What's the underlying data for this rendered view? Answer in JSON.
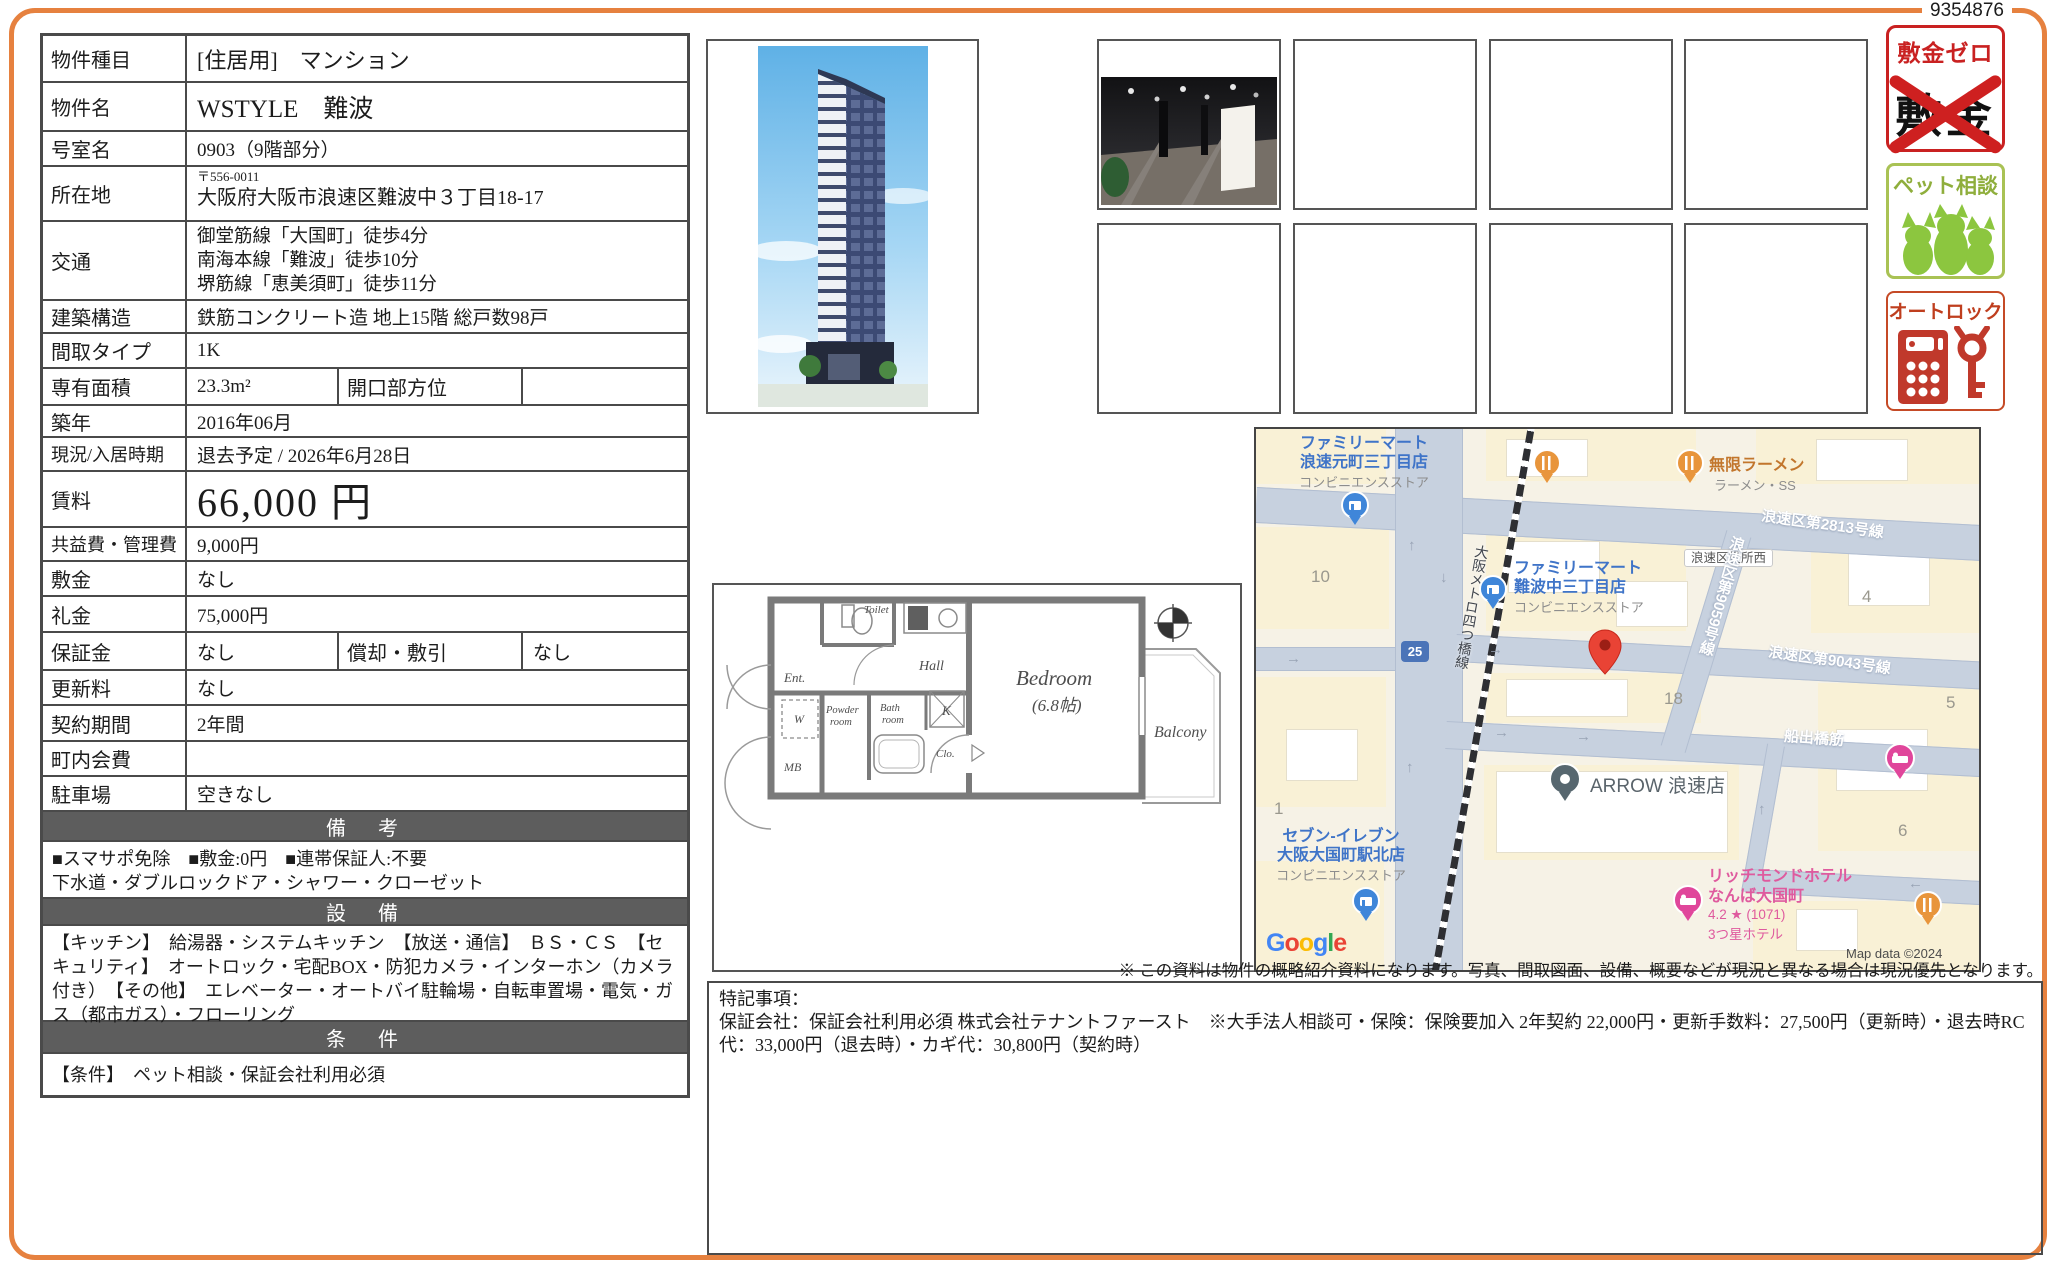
{
  "page": {
    "doc_number": "9354876",
    "disclaimer": "※ この資料は物件の概略紹介資料になります。写真、間取図面、設備、概要などが現況と異なる場合は現況優先となります。"
  },
  "table": {
    "rows": {
      "type": {
        "label": "物件種目",
        "value": "[住居用]　マンション"
      },
      "name": {
        "label": "物件名",
        "value": "WSTYLE　難波"
      },
      "room": {
        "label": "号室名",
        "value": "0903（9階部分）"
      },
      "address": {
        "label": "所在地",
        "zip": "〒556-0011",
        "value": "大阪府大阪市浪速区難波中３丁目18-17"
      },
      "access": {
        "label": "交通",
        "line1": "御堂筋線「大国町」徒歩4分",
        "line2": "南海本線「難波」徒歩10分",
        "line3": "堺筋線「恵美須町」徒歩11分"
      },
      "structure": {
        "label": "建築構造",
        "value": "鉄筋コンクリート造 地上15階 総戸数98戸"
      },
      "layout": {
        "label": "間取タイプ",
        "value": "1K"
      },
      "area": {
        "label": "専有面積",
        "value": "23.3m²",
        "sublabel": "開口部方位",
        "subvalue": ""
      },
      "built": {
        "label": "築年",
        "value": "2016年06月"
      },
      "status": {
        "label": "現況/入居時期",
        "value": "退去予定 / 2026年6月28日"
      },
      "rent": {
        "label": "賃料",
        "value": "66,000 円"
      },
      "fees": {
        "label": "共益費・管理費",
        "value": "9,000円"
      },
      "deposit": {
        "label": "敷金",
        "value": "なし"
      },
      "keymoney": {
        "label": "礼金",
        "value": "75,000円"
      },
      "guarantee": {
        "label": "保証金",
        "value": "なし",
        "sublabel": "償却・敷引",
        "subvalue": "なし"
      },
      "renewal": {
        "label": "更新料",
        "value": "なし"
      },
      "term": {
        "label": "契約期間",
        "value": "2年間"
      },
      "association": {
        "label": "町内会費",
        "value": ""
      },
      "parking": {
        "label": "駐車場",
        "value": "空きなし"
      }
    },
    "sections": {
      "remarks": {
        "title": "備　考",
        "line1": "■スマサポ免除　■敷金:0円　■連帯保証人:不要",
        "line2": "下水道・ダブルロックドア・シャワー・クローゼット"
      },
      "equipment": {
        "title": "設　備",
        "text": "【キッチン】　給湯器・システムキッチン　【放送・通信】　ＢＳ・ＣＳ　【セキュリティ】　オートロック・宅配BOX・防犯カメラ・インターホン（カメラ付き）　【その他】　エレベーター・オートバイ駐輪場・自転車置場・電気・ガス（都市ガス）・フローリング"
      },
      "conditions": {
        "title": "条　件",
        "text": "【条件】　ペット相談・保証会社利用必須"
      }
    }
  },
  "badges": {
    "shikikin_zero": {
      "title": "敷金ゼロ",
      "crossed_text": "敷金"
    },
    "pet": {
      "title": "ペット相談"
    },
    "autolock": {
      "title": "オートロック"
    }
  },
  "floorplan": {
    "labels": {
      "ent": "Ent.",
      "w": "W",
      "powder1": "Powder",
      "powder2": "room",
      "bath1": "Bath",
      "bath2": "room",
      "mb": "MB",
      "hall": "Hall",
      "toilet": "Toilet",
      "k": "K",
      "clo": "Clo.",
      "bedroom": "Bedroom",
      "bedroom_size": "(6.8帖)",
      "balcony": "Balcony"
    }
  },
  "map": {
    "labels": {
      "fm1_1": "ファミリーマート",
      "fm1_2": "浪速元町三丁目店",
      "fm1_sub": "コンビニエンスストア",
      "ramen": "無限ラーメン",
      "ramen_sub": "ラーメン・SS",
      "road2813": "浪速区第2813号線",
      "ward_office": "浪速区役所西",
      "b10": "10",
      "b4": "4",
      "b18": "18",
      "b5": "5",
      "b1": "1",
      "b6": "6",
      "fm2_1": "ファミリーマート",
      "fm2_2": "難波中三丁目店",
      "fm2_sub": "コンビニエンスストア",
      "route25": "25",
      "road9059": "浪速区第9059号線",
      "road9043": "浪速区第9043号線",
      "funade": "船出橋筋",
      "arrow_poi": "ARROW 浪速店",
      "seven1": "セブン-イレブン",
      "seven2": "大阪大国町駅北店",
      "seven_sub": "コンビニエンスストア",
      "metro": "大阪メトロ四つ橋線",
      "richmond1": "リッチモンドホテル",
      "richmond2": "なんば大国町",
      "richmond_rating": "4.2 ★ (1071)",
      "richmond3": "3つ星ホテル",
      "google_letters": [
        "G",
        "o",
        "o",
        "g",
        "l",
        "e"
      ],
      "map_data": "Map data ©2024",
      "arrow_up": "↑",
      "arrow_down": "↓",
      "arrow_right": "→",
      "arrow_left": "←"
    }
  },
  "notes": {
    "title": "特記事項：",
    "body": "保証会社：保証会社利用必須 株式会社テナントファースト　※大手法人相談可・保険：保険要加入 2年契約 22,000円・更新手数料：27,500円（更新時）・退去時RC代：33,000円（退去時）・カギ代：30,800円（契約時）"
  }
}
